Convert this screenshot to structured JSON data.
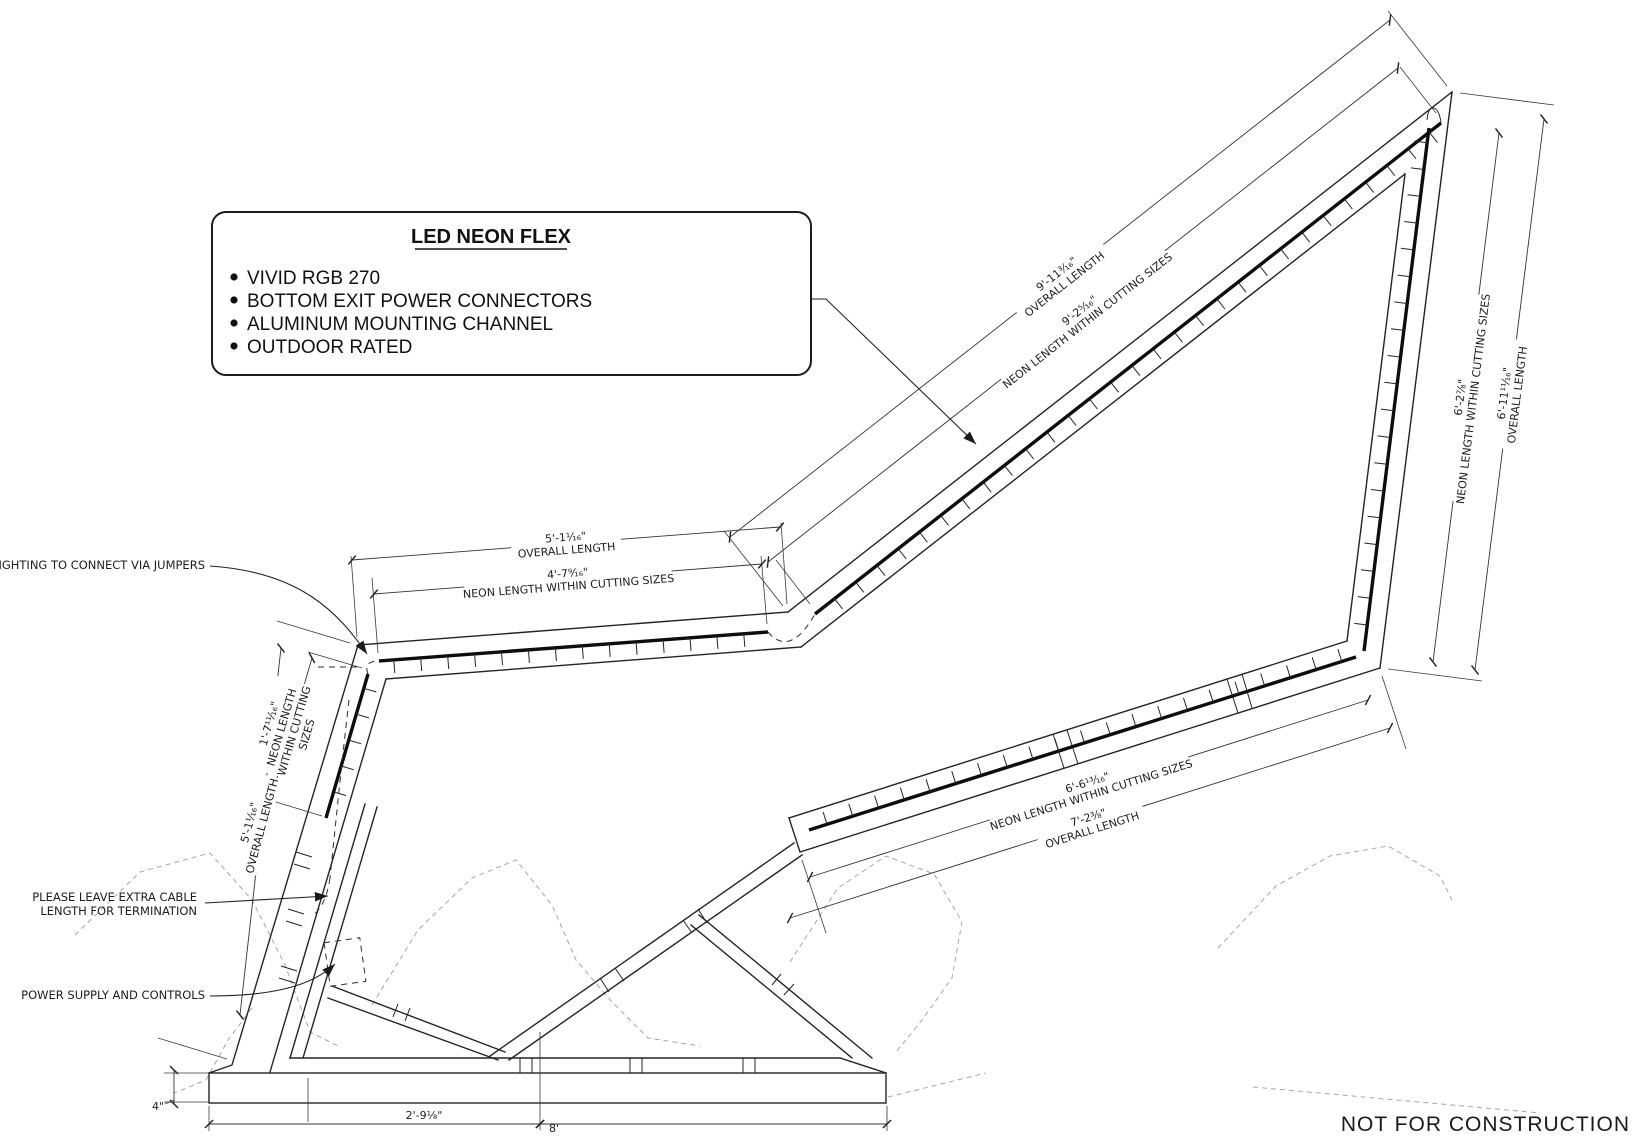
{
  "drawing": {
    "callout": {
      "title": "LED NEON FLEX",
      "bullets": [
        "VIVID RGB 270",
        "BOTTOM EXIT POWER CONNECTORS",
        "ALUMINUM MOUNTING CHANNEL",
        "OUTDOOR RATED"
      ]
    },
    "annotations": {
      "jumpers": "LIGHTING TO CONNECT VIA JUMPERS",
      "extra_cable_1": "PLEASE LEAVE EXTRA CABLE",
      "extra_cable_2": "LENGTH FOR TERMINATION",
      "power_supply": "POWER SUPPLY AND CONTROLS"
    },
    "dims": {
      "top_overall_value": "9'-11³⁄₁₆\"",
      "top_overall_name": "OVERALL LENGTH",
      "top_neon_value": "9'-2⁵⁄₁₆\"",
      "top_neon_name": "NEON LENGTH WITHIN CUTTING SIZES",
      "right_neon_value": "6'-2⁷⁄₈\"",
      "right_neon_name": "NEON LENGTH WITHIN CUTTING SIZES",
      "right_overall_value": "6'-11¹¹⁄₁₆\"",
      "right_overall_name": "OVERALL LENGTH",
      "mid_overall_value": "5'-1¹⁄₁₆\"",
      "mid_overall_name": "OVERALL LENGTH",
      "mid_neon_value": "4'-7⁹⁄₁₆\"",
      "mid_neon_name": "NEON LENGTH WITHIN CUTTING SIZES",
      "left_neon_value": "1'-7¹¹⁄₁₆\"",
      "left_neon_name_1": "NEON LENGTH",
      "left_neon_name_2": "WITHIN CUTTING",
      "left_neon_name_3": "SIZES",
      "left_overall_value": "5'-1¹⁄₁₆\"",
      "left_overall_name": "OVERALL LENGTH",
      "lower_neon_value": "6'-6¹³⁄₁₆\"",
      "lower_neon_name": "NEON LENGTH WITHIN CUTTING SIZES",
      "lower_overall_value": "7'-2³⁄₈\"",
      "lower_overall_name": "OVERALL LENGTH",
      "base_height": "4\"",
      "base_width_left": "2'-9¹⁄₈\"",
      "base_width_right": "8'"
    },
    "footer_note": "NOT FOR CONSTRUCTION"
  }
}
